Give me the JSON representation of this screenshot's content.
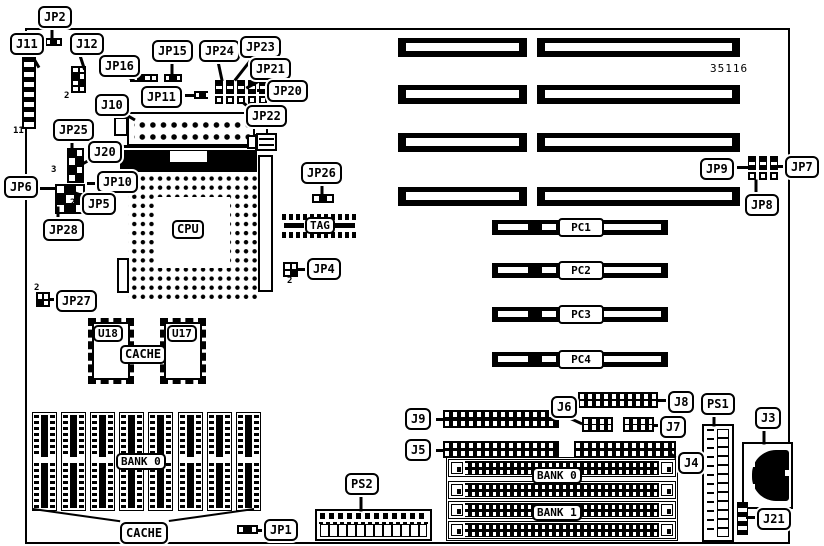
{
  "part_number": "35116",
  "callouts": {
    "jp2": "JP2",
    "j11": "J11",
    "j12": "J12",
    "jp16": "JP16",
    "jp15": "JP15",
    "jp24": "JP24",
    "jp23": "JP23",
    "jp21": "JP21",
    "jp20": "JP20",
    "j10": "J10",
    "jp11": "JP11",
    "jp22": "JP22",
    "jp25": "JP25",
    "j20": "J20",
    "jp6": "JP6",
    "jp10": "JP10",
    "jp5": "JP5",
    "jp28": "JP28",
    "jp26": "JP26",
    "jp4": "JP4",
    "jp27": "JP27",
    "jp9": "JP9",
    "jp7": "JP7",
    "jp8": "JP8",
    "j9": "J9",
    "j6": "J6",
    "j8": "J8",
    "j7": "J7",
    "j5": "J5",
    "j4": "J4",
    "ps1": "PS1",
    "j3": "J3",
    "j21": "J21",
    "ps2": "PS2",
    "jp1": "JP1",
    "cache_bottom": "CACHE"
  },
  "chips": {
    "cpu": "CPU",
    "tag": "TAG",
    "u18": "U18",
    "u17": "U17",
    "cache_mid": "CACHE"
  },
  "slots": {
    "pc1": "PC1",
    "pc2": "PC2",
    "pc3": "PC3",
    "pc4": "PC4"
  },
  "banks": {
    "dip_bank0": "BANK 0",
    "simm_bank0": "BANK 0",
    "simm_bank1": "BANK 1"
  },
  "pins": {
    "j11": "11",
    "j12": "2",
    "cluster3": "3",
    "cluster2": "2",
    "jp27": "2",
    "jp4": "2"
  }
}
